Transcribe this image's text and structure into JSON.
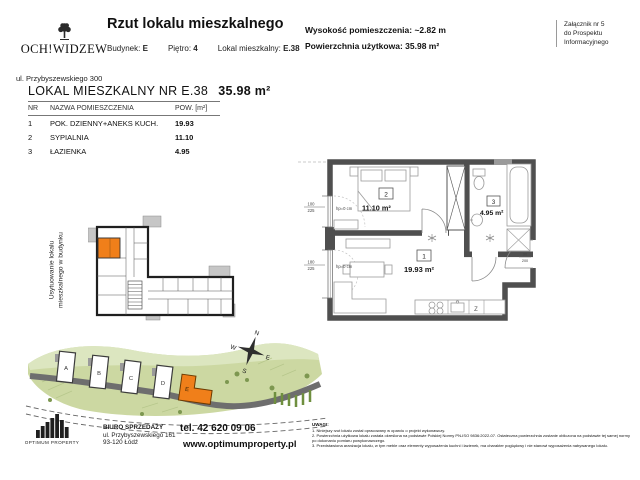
{
  "header": {
    "brand": {
      "text": "OCH!WIDZEW"
    },
    "title": "Rzut lokalu mieszkalnego",
    "meta": [
      {
        "label": "Budynek:",
        "value": "E"
      },
      {
        "label": "Piętro:",
        "value": "4"
      },
      {
        "label": "Lokal mieszkalny:",
        "value": "E.38"
      }
    ],
    "specs": [
      {
        "label": "Wysokość pomieszczenia:",
        "value": "~2.82 m"
      },
      {
        "label": "Powierzchnia użytkowa:",
        "value": "35.98 m²"
      }
    ],
    "attachment": {
      "line1": "Załącznik nr 5",
      "line2": "do Prospektu",
      "line3": "Informacyjnego"
    }
  },
  "address": "ul. Przybyszewskiego 300",
  "unit": {
    "title": "LOKAL MIESZKALNY NR E.38",
    "area": "35.98 m²"
  },
  "rooms_table": {
    "headers": {
      "nr": "NR",
      "name": "NAZWA POMIESZCZENIA",
      "area": "POW. [m²]"
    },
    "rows": [
      {
        "nr": "1",
        "name": "POK. DZIENNY+ANEKS KUCH.",
        "area": "19.93"
      },
      {
        "nr": "2",
        "name": "SYPIALNIA",
        "area": "11.10"
      },
      {
        "nr": "3",
        "name": "ŁAZIENKA",
        "area": "4.95"
      }
    ]
  },
  "mini_plan": {
    "caption_line1": "Usytuowanie lokalu",
    "caption_line2": "mieszkalnego w budynku"
  },
  "floor_plan": {
    "rooms": [
      {
        "nr": "1",
        "area": "19.93 m²"
      },
      {
        "nr": "2",
        "area": "11.10 m²"
      },
      {
        "nr": "3",
        "area": "4.95 m²"
      }
    ],
    "windows": [
      {
        "width": "100",
        "height": "225",
        "sill": "hp=0 cm"
      },
      {
        "width": "180",
        "height": "225",
        "sill": "hp=0 cm"
      }
    ],
    "entry_door": {
      "width": "90",
      "height": "200"
    },
    "kitchen_mark": "Z"
  },
  "site_plan": {
    "buildings": [
      {
        "label": "A"
      },
      {
        "label": "B"
      },
      {
        "label": "C"
      },
      {
        "label": "D"
      },
      {
        "label": "E"
      }
    ],
    "highlighted": "E",
    "compass": {
      "n": "N",
      "e": "E",
      "s": "S",
      "w": "W"
    }
  },
  "footer": {
    "brand": "OPTIMUM PROPERTY",
    "sales_office": {
      "title": "BIURO SPRZEDAŻY",
      "address1": "ul. Przybyszewskiego 161",
      "address2": "93-120 Łódź"
    },
    "phone": "tel. 42 620 09 06",
    "website": "www.optimumproperty.pl",
    "notes_title": "UWAGI:",
    "notes": [
      "1. Niniejszy rzut lokalu został opracowany w oparciu o projekt wykonawczy.",
      "2. Powierzchnia użytkowa lokalu została określona na podstawie Polskiej Normy PN-ISO 9836:2022-07. Ostateczna powierzchnia zostanie obliczona na podstawie tej samej normy po dokonaniu pomiaru powykonawczego.",
      "3. Przedstawiona aranżacja lokalu, w tym meble oraz elementy wyposażenia kuchni i łazienek, ma charakter poglądowy i nie stanowi wyposażenia nabywanego lokalu."
    ]
  },
  "colors": {
    "highlight": "#F07F1A",
    "wall": "#4F4F4F",
    "site_green": "#CCD8A2"
  }
}
